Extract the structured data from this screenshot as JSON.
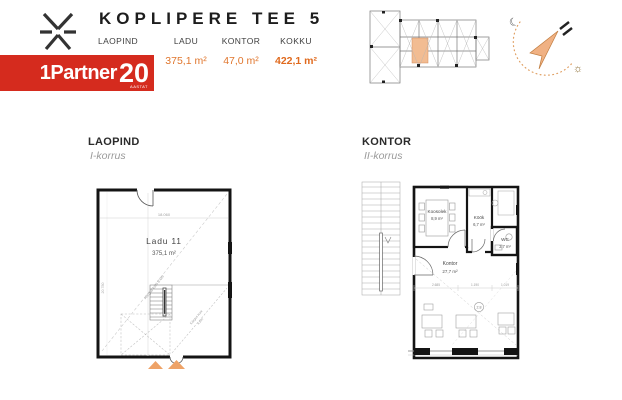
{
  "header": {
    "title": "KOPLIPERE TEE 5",
    "stats": [
      {
        "label": "LAOPIND",
        "value": ""
      },
      {
        "label": "LADU",
        "value": "375,1 m²"
      },
      {
        "label": "KONTOR",
        "value": "47,0 m²"
      },
      {
        "label": "KOKKU",
        "value": "422,1 m²"
      }
    ],
    "brand": {
      "name": "1Partner",
      "number": "20",
      "sub": "AASTAT"
    }
  },
  "colors": {
    "accent_orange": "#e0762d",
    "brand_red": "#d52b1e",
    "unit_highlight": "#f2bc92",
    "plan_wall": "#141414"
  },
  "compass": {
    "moon": "☾",
    "sun": "☼"
  },
  "laopind": {
    "section_title": "LAOPIND",
    "section_subtitle": "I-korrus",
    "room_name": "Ladu 11",
    "room_area": "375,1 m²",
    "dim_top": "18.060",
    "dim_left": "20.780",
    "note_height1": "Kõrgus kuni 6.0m",
    "note_height2_line1": "Kõrgus kuni",
    "note_height2_line2": "4.5m"
  },
  "kontor": {
    "section_title": "KONTOR",
    "section_subtitle": "II-korrus",
    "rooms": {
      "koosolek": {
        "name": "Koosolek",
        "area": "8,9 m²"
      },
      "kook": {
        "name": "Köök",
        "area": "6,7 m²"
      },
      "wc": {
        "name": "WC",
        "area": "3,7 m²"
      },
      "kontor": {
        "name": "Kontor",
        "area": "27,7 m²"
      }
    },
    "dims": {
      "d1": "2.685",
      "d2": "1.190",
      "d3": "1.019"
    },
    "height_badge": "2.8"
  }
}
